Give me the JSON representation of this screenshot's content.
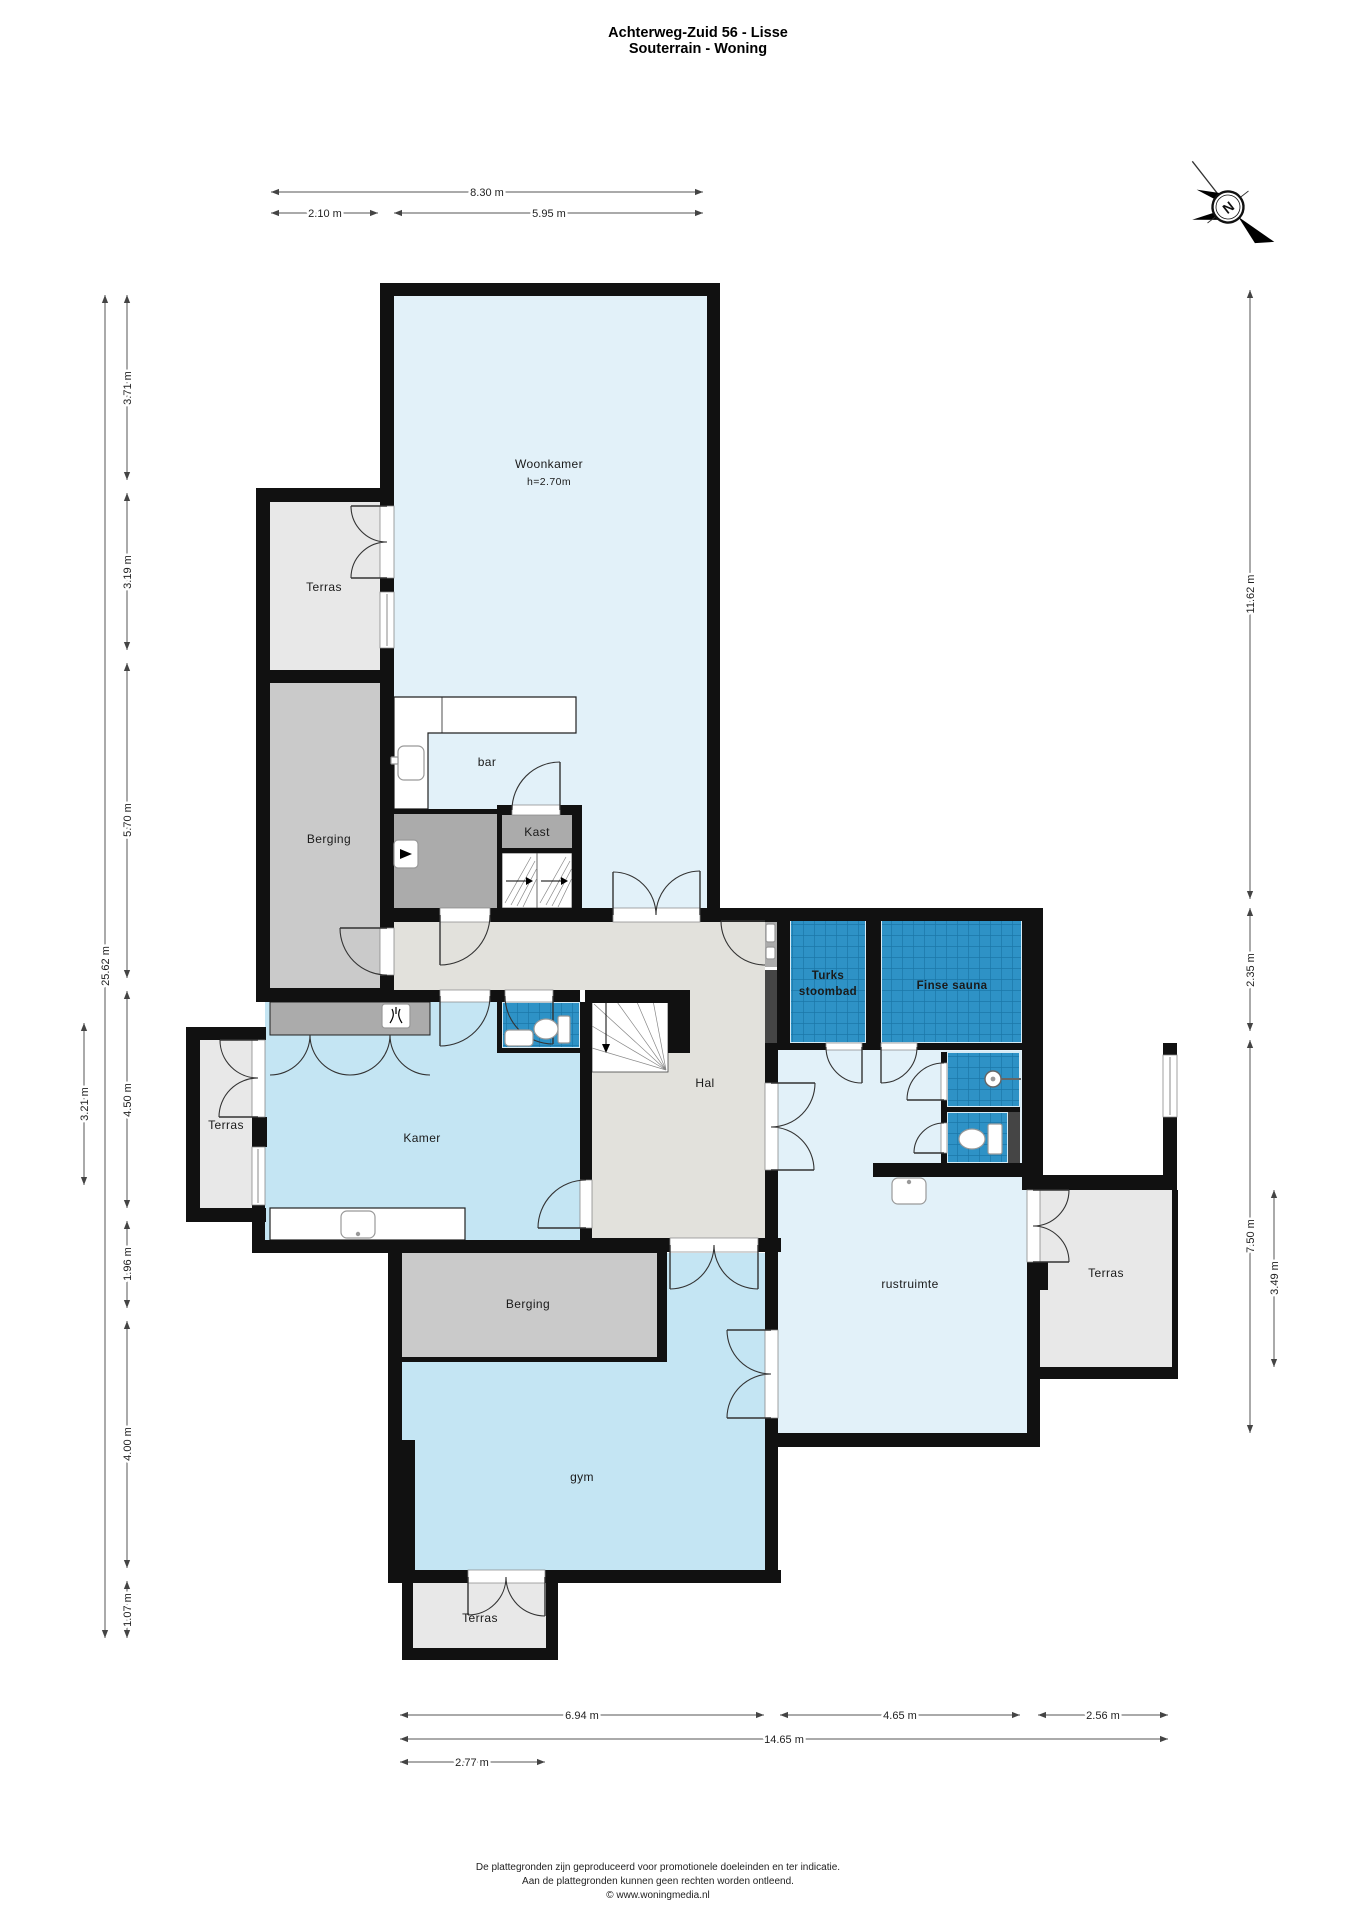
{
  "title": {
    "line1": "Achterweg-Zuid 56 - Lisse",
    "line2": "Souterrain - Woning"
  },
  "compass": {
    "north": "N"
  },
  "rooms": {
    "woonkamer": {
      "label": "Woonkamer",
      "ceiling_height": "h=2.70m"
    },
    "terras_nw": {
      "label": "Terras"
    },
    "berging_west": {
      "label": "Berging"
    },
    "bar": {
      "label": "bar"
    },
    "kast": {
      "label": "Kast"
    },
    "hal": {
      "label": "Hal"
    },
    "kamer": {
      "label": "Kamer"
    },
    "terras_west": {
      "label": "Terras"
    },
    "turks_stoombad": {
      "line1": "Turks",
      "line2": "stoombad"
    },
    "finse_sauna": {
      "label": "Finse sauna"
    },
    "rustruimte": {
      "label": "rustruimte"
    },
    "terras_east": {
      "label": "Terras"
    },
    "berging_south": {
      "label": "Berging"
    },
    "gym": {
      "label": "gym"
    },
    "terras_south": {
      "label": "Terras"
    }
  },
  "dimensions": {
    "top": [
      "8.30 m",
      "2.10 m",
      "5.95 m"
    ],
    "left": [
      "3.71 m",
      "3.19 m",
      "5.70 m",
      "4.50 m",
      "1.96 m",
      "4.00 m",
      "1.07 m",
      "25.62 m",
      "3.21 m"
    ],
    "right": [
      "11.62 m",
      "2.35 m",
      "7.50 m",
      "3.49 m"
    ],
    "bottom": [
      "6.94 m",
      "4.65 m",
      "2.56 m",
      "14.65 m",
      "2.77 m"
    ]
  },
  "footer": {
    "line1": "De plattegronden zijn geproduceerd voor promotionele doeleinden en ter indicatie.",
    "line2": "Aan de plattegronden kunnen geen rechten worden ontleend.",
    "line3": "© www.woningmedia.nl"
  },
  "colors": {
    "wall": "#111111",
    "floor_pale_blue": "#E2F1F9",
    "floor_mid_blue": "#C4E5F3",
    "tile_blue": "#2E92C6",
    "tile_grid": "#1B77A8",
    "floor_terrace": "#E8E8E8",
    "floor_storage": "#CACACA",
    "floor_dark": "#ABABAB",
    "floor_hall": "#E2E1DC",
    "dark_shaft": "#454545"
  }
}
